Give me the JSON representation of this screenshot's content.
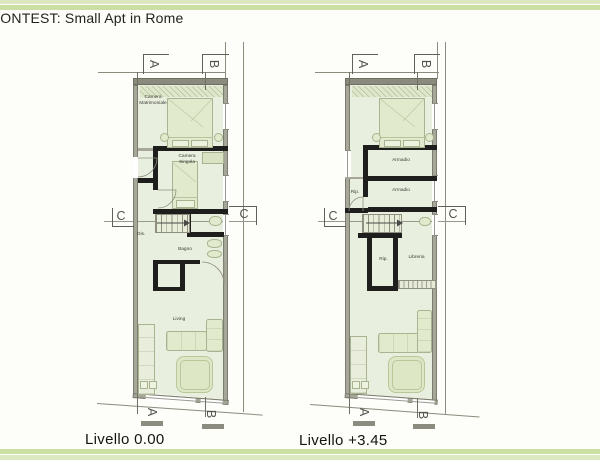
{
  "title": "CONTEST: Small Apt in Rome",
  "markers": {
    "a": "A",
    "b": "B",
    "c": "C"
  },
  "plan_left": {
    "label": "Livello 0.00",
    "rooms": {
      "camera_matrimoniale": "Camera Matrimoniale",
      "camera_singola": "Camera Singola",
      "dis": "Dis.",
      "bagno": "Bagno",
      "living": "Living"
    }
  },
  "plan_right": {
    "label": "Livello +3.45",
    "rooms": {
      "armadio_top": "Armadio",
      "armadio_mid": "Armadio",
      "rip_top": "Rip.",
      "rip_mid": "Rip.",
      "libreria": "Libreria"
    }
  },
  "palette": {
    "border_green_light": "#dce8c0",
    "border_green_dark": "#cbdfa3",
    "room_fill": "#e9efde",
    "wall_gray": "#a6a699",
    "wall_dark_gray": "#8a8a7d",
    "new_partition_black": "#1e1e1c",
    "furniture_fill": "#e2eace",
    "furniture_stroke": "#a8b490"
  }
}
